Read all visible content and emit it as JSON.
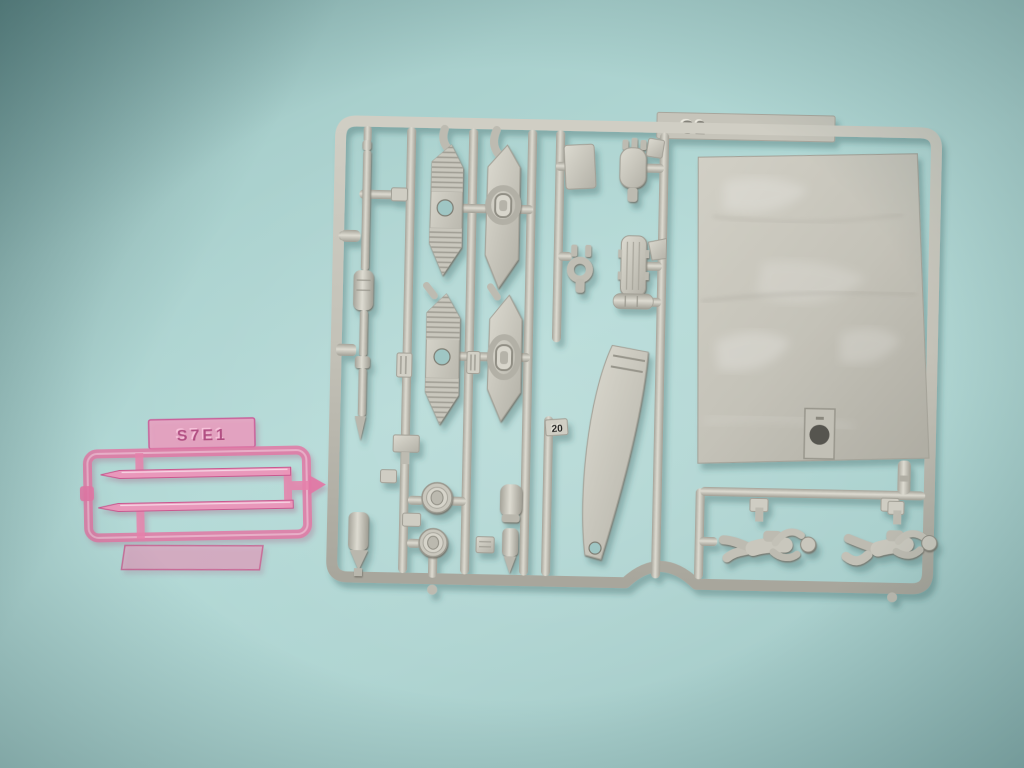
{
  "colors": {
    "background": "#aed5d2",
    "gray_plastic": "#c7c5bb",
    "gray_plastic_shadow": "#9e9c92",
    "gray_plastic_highlight": "#e4e2d8",
    "pink_plastic": "#e78fb8",
    "pink_plastic_edge": "#c75d95",
    "hole_show_through": "#9fc6c4"
  },
  "gray_sprue": {
    "tab_label": "C2",
    "part_tag_label": "20"
  },
  "pink_sprue": {
    "tag_label": "S7E1"
  }
}
